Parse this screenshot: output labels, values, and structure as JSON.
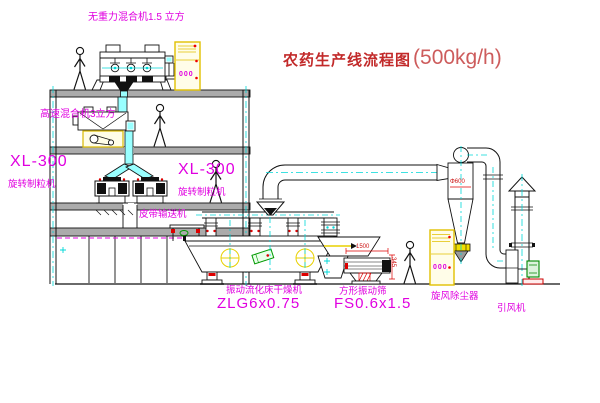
{
  "title": {
    "text": "农药生产线流程图",
    "capacity": "(500kg/h)"
  },
  "labels": {
    "gravity_free_mixer": "无重力混合机1.5 立方",
    "high_speed_mixer": "高速混合机3立方",
    "granulator_left": {
      "model": "XL-300",
      "name": "旋转制粒机"
    },
    "granulator_right": {
      "model": "XL-300",
      "name": "旋转制粒机"
    },
    "belt_conveyor": "皮带输送机",
    "dryer": {
      "name": "振动流化床干燥机",
      "model": "ZLG6x0.75"
    },
    "sieve": {
      "name": "方形振动筛",
      "model": "FS0.6x1.5"
    },
    "cyclone": "旋风除尘器",
    "fan": "引风机"
  },
  "annotations": {
    "sieve_length": "1500",
    "sieve_height": "345",
    "cyclone_diameter": "Φ600",
    "cabinet1_display": "000",
    "cabinet2_display": "000"
  },
  "colors": {
    "label_magenta": "#e000e0",
    "title_red": "#c22a2a",
    "capacity_red": "#cd5c5c",
    "line_black": "#111111",
    "centerline_cyan": "#00d8d8",
    "cabinet_yellow": "#e2c000",
    "accent_red": "#cc0000",
    "accent_green": "#009900",
    "slab_gray": "#ababab"
  }
}
